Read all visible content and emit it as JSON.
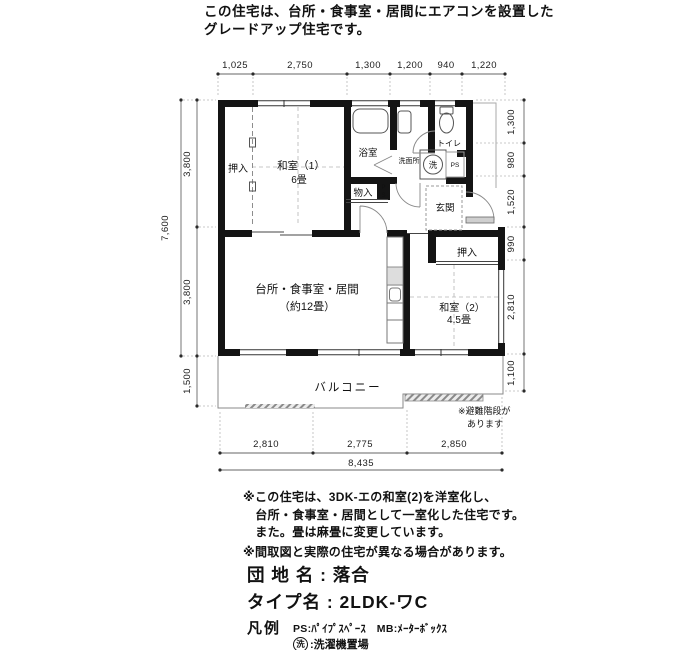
{
  "header": {
    "line1": "この住宅は、台所・食事室・居間にエアコンを設置した",
    "line2": "グレードアップ住宅です。"
  },
  "dims": {
    "top": [
      "1,025",
      "2,750",
      "1,300",
      "1,200",
      "940",
      "1,220"
    ],
    "left_total": "7,600",
    "left": [
      "3,800",
      "3,800",
      "1,500"
    ],
    "right": [
      "1,300",
      "980",
      "1,520",
      "990",
      "2,810",
      "1,100"
    ],
    "bottom": [
      "2,810",
      "2,775",
      "2,850"
    ],
    "bottom_total": "8,435"
  },
  "rooms": {
    "oshiire1": {
      "label": "押入"
    },
    "washitsu1": {
      "name": "和室（1）",
      "size": "6畳"
    },
    "bath": {
      "label": "浴室"
    },
    "monoire": {
      "label": "物入"
    },
    "washroom": {
      "label": "洗面所"
    },
    "laundry": {
      "label": "洗"
    },
    "toilet": {
      "label": "トイレ"
    },
    "ps1": {
      "label": "PS"
    },
    "ps2": {
      "p": "P",
      "s": "S"
    },
    "genkan": {
      "label": "玄関"
    },
    "ldk": {
      "name": "台所・食事室・居間",
      "size": "（約12畳）"
    },
    "oshiire2": {
      "label": "押入"
    },
    "washitsu2": {
      "name": "和室（2）",
      "size": "4.5畳"
    },
    "balcony": {
      "label": "バルコニー"
    }
  },
  "plan_note": {
    "line1": "※避難階段が",
    "line2": "あります"
  },
  "notes": [
    "※この住宅は、3DK-エの和室(2)を洋室化し、",
    "　台所・食事室・居間として一室化した住宅です。",
    "　また。畳は麻畳に変更しています。",
    "※間取図と実際の住宅が異なる場合があります。"
  ],
  "footer": {
    "estate": "団 地 名 : 落合",
    "type_name": "タイプ名 : 2LDK-ワC",
    "legend_title": "凡例",
    "legend_items": "PS:ﾊﾟｲﾌﾟｽﾍﾟｰｽ　MB:ﾒｰﾀｰﾎﾞｯｸｽ",
    "laundry_mark": "洗",
    "laundry_text": ":洗濯機置場"
  }
}
